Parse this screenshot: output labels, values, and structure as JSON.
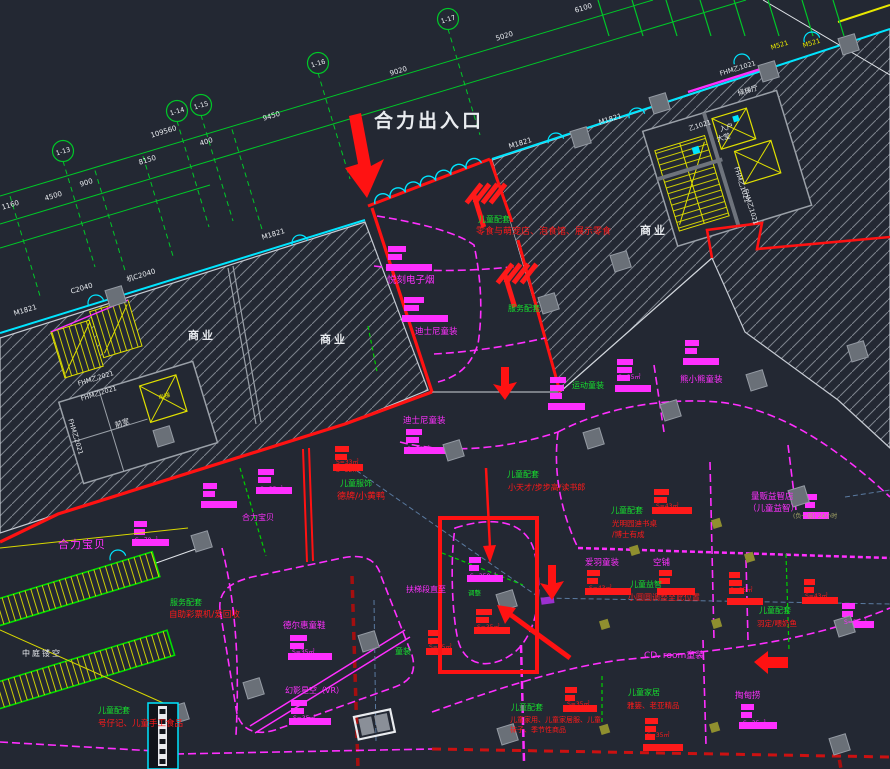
{
  "colors": {
    "background": "#232833",
    "green": "#16e02e",
    "red": "#ff1a1a",
    "magenta": "#ff2fff",
    "cyan": "#00e5ff",
    "yellow": "#e8e800",
    "white": "#e9ecf0",
    "olive": "#a8a868",
    "grid_green": "#00c828",
    "hatch_gray": "#8d939d"
  },
  "entrance": {
    "label": "合力出入口"
  },
  "grid": {
    "bubbles": [
      {
        "t": "1-13",
        "x": 63,
        "y": 151
      },
      {
        "t": "1-14",
        "x": 177,
        "y": 111
      },
      {
        "t": "1-15",
        "x": 201,
        "y": 105
      },
      {
        "t": "1-16",
        "x": 318,
        "y": 63
      },
      {
        "t": "1-17",
        "x": 448,
        "y": 19
      }
    ],
    "dims": [
      {
        "t": "1160",
        "x": 1,
        "y": 205
      },
      {
        "t": "4500",
        "x": 44,
        "y": 196
      },
      {
        "t": "900",
        "x": 79,
        "y": 182
      },
      {
        "t": "8150",
        "x": 138,
        "y": 160
      },
      {
        "t": "109560",
        "x": 150,
        "y": 133
      },
      {
        "t": "400",
        "x": 199,
        "y": 141
      },
      {
        "t": "9450",
        "x": 262,
        "y": 116
      },
      {
        "t": "9020",
        "x": 389,
        "y": 71
      },
      {
        "t": "5020",
        "x": 495,
        "y": 36
      },
      {
        "t": "6100",
        "x": 574,
        "y": 8
      }
    ]
  },
  "labels": {
    "areas": [
      {
        "t": "商业",
        "x": 188,
        "y": 330,
        "c": "w",
        "s": 11,
        "ls": 3,
        "b": 1
      },
      {
        "t": "商业",
        "x": 320,
        "y": 334,
        "c": "w",
        "s": 11,
        "ls": 3,
        "b": 1
      },
      {
        "t": "商业",
        "x": 640,
        "y": 225,
        "c": "w",
        "s": 11,
        "ls": 3,
        "b": 1
      },
      {
        "t": "中庭镂空",
        "x": 22,
        "y": 650,
        "c": "w",
        "s": 8,
        "ls": 2
      },
      {
        "t": "前室",
        "x": 114,
        "y": 422,
        "c": "w",
        "s": 7.5,
        "r": -17
      },
      {
        "t": "入户",
        "x": 719,
        "y": 127,
        "c": "w",
        "s": 7,
        "r": -17
      },
      {
        "t": "大堂",
        "x": 716,
        "y": 137,
        "c": "w",
        "s": 7,
        "r": -17
      },
      {
        "t": "候梯厅",
        "x": 737,
        "y": 91,
        "c": "w",
        "s": 7,
        "r": -17
      }
    ],
    "doors": [
      {
        "t": "M1821",
        "x": 13,
        "y": 311,
        "c": "w",
        "s": 7,
        "r": -17
      },
      {
        "t": "C2040",
        "x": 70,
        "y": 289,
        "c": "w",
        "s": 7,
        "r": -17
      },
      {
        "t": "机C2040",
        "x": 126,
        "y": 277,
        "c": "w",
        "s": 7,
        "r": -17
      },
      {
        "t": "M1821",
        "x": 261,
        "y": 235,
        "c": "w",
        "s": 7,
        "r": -17
      },
      {
        "t": "M1821",
        "x": 508,
        "y": 144,
        "c": "w",
        "s": 7,
        "r": -17
      },
      {
        "t": "M1821",
        "x": 598,
        "y": 120,
        "c": "w",
        "s": 7,
        "r": -17
      },
      {
        "t": "FHM乙2021",
        "x": 77,
        "y": 381,
        "c": "w",
        "s": 6.5,
        "r": -17
      },
      {
        "t": "FHM乙2021",
        "x": 80,
        "y": 396,
        "c": "w",
        "s": 6.5,
        "r": -17
      },
      {
        "t": "FHM乙2021",
        "x": 73,
        "y": 418,
        "c": "w",
        "s": 6.5,
        "r": 73
      },
      {
        "t": "FHM乙1021",
        "x": 719,
        "y": 71,
        "c": "w",
        "s": 6.5,
        "r": -17
      },
      {
        "t": "乙1021",
        "x": 688,
        "y": 126,
        "c": "w",
        "s": 6.5,
        "r": -17
      },
      {
        "t": "FHM乙1021",
        "x": 739,
        "y": 166,
        "c": "w",
        "s": 6.5,
        "r": 73
      },
      {
        "t": "FHM乙1021",
        "x": 748,
        "y": 188,
        "c": "w",
        "s": 6.5,
        "r": 73
      },
      {
        "t": "M521",
        "x": 770,
        "y": 45,
        "c": "y",
        "s": 6.5,
        "r": -17
      },
      {
        "t": "M521",
        "x": 802,
        "y": 43,
        "c": "y",
        "s": 6.5,
        "r": -17
      },
      {
        "t": "电梯",
        "x": 158,
        "y": 396,
        "c": "y",
        "s": 6,
        "r": -17
      }
    ],
    "categories": [
      {
        "t": "儿童配套",
        "x": 478,
        "y": 216,
        "c": "g",
        "s": 8
      },
      {
        "t": "服务配套",
        "x": 508,
        "y": 305,
        "c": "g",
        "s": 8
      },
      {
        "t": "儿童服饰",
        "x": 340,
        "y": 480,
        "c": "g",
        "s": 8
      },
      {
        "t": "儿童配套",
        "x": 507,
        "y": 471,
        "c": "g",
        "s": 8
      },
      {
        "t": "运动童装",
        "x": 572,
        "y": 382,
        "c": "g",
        "s": 8
      },
      {
        "t": "儿童配套",
        "x": 611,
        "y": 507,
        "c": "g",
        "s": 8
      },
      {
        "t": "儿童益智",
        "x": 630,
        "y": 581,
        "c": "g",
        "s": 8
      },
      {
        "t": "儿童配套",
        "x": 759,
        "y": 607,
        "c": "g",
        "s": 8
      },
      {
        "t": "服务配套",
        "x": 170,
        "y": 599,
        "c": "g",
        "s": 8
      },
      {
        "t": "儿童配套",
        "x": 98,
        "y": 707,
        "c": "g",
        "s": 8
      },
      {
        "t": "童装",
        "x": 395,
        "y": 648,
        "c": "g",
        "s": 8
      },
      {
        "t": "儿童配套",
        "x": 511,
        "y": 704,
        "c": "g",
        "s": 8
      },
      {
        "t": "儿童家居",
        "x": 628,
        "y": 689,
        "c": "g",
        "s": 8
      },
      {
        "t": "调整",
        "x": 468,
        "y": 590,
        "c": "g",
        "s": 6.5
      }
    ],
    "shops_red": [
      {
        "t": "零食与萌宠店、泡食馆、展示零食",
        "x": 476,
        "y": 228,
        "c": "r",
        "s": 9
      },
      {
        "t": "德牌/小黄鸭",
        "x": 337,
        "y": 493,
        "c": "r",
        "s": 9
      },
      {
        "t": "小天才/步步高/读书郎",
        "x": 508,
        "y": 484,
        "c": "r",
        "s": 8
      },
      {
        "t": "光明园迪书桌",
        "x": 612,
        "y": 520,
        "c": "r",
        "s": 7.5
      },
      {
        "t": "/博士有成",
        "x": 612,
        "y": 531,
        "c": "r",
        "s": 7.5
      },
      {
        "t": "小圆圆调整至此位置",
        "x": 628,
        "y": 594,
        "c": "r",
        "s": 8
      },
      {
        "t": "羽定/喂奶鱼",
        "x": 757,
        "y": 620,
        "c": "r",
        "s": 7.5
      },
      {
        "t": "自助彩票机/爱回收",
        "x": 169,
        "y": 611,
        "c": "r",
        "s": 8.5
      },
      {
        "t": "号仔记、儿童手工食品",
        "x": 98,
        "y": 720,
        "c": "r",
        "s": 8.5
      },
      {
        "t": "儿童家用、儿童家居服、儿童",
        "x": 510,
        "y": 717,
        "c": "r",
        "s": 7
      },
      {
        "t": "袜子、季节性商品",
        "x": 510,
        "y": 727,
        "c": "r",
        "s": 7
      },
      {
        "t": "雅篓、老亚精品",
        "x": 627,
        "y": 702,
        "c": "r",
        "s": 7.5
      }
    ],
    "shops_magenta": [
      {
        "t": "悦刻电子烟",
        "x": 387,
        "y": 276,
        "c": "m",
        "s": 9.5
      },
      {
        "t": "迪士尼童装",
        "x": 415,
        "y": 328,
        "c": "m",
        "s": 8.5
      },
      {
        "t": "迪士尼童装",
        "x": 403,
        "y": 417,
        "c": "m",
        "s": 8.5
      },
      {
        "t": "合力宝贝",
        "x": 242,
        "y": 514,
        "c": "m",
        "s": 8
      },
      {
        "t": "合力宝贝",
        "x": 58,
        "y": 539,
        "c": "m",
        "s": 11,
        "ls": 1
      },
      {
        "t": "德尔惠童鞋",
        "x": 283,
        "y": 622,
        "c": "m",
        "s": 8.5
      },
      {
        "t": "幻影星空（VR）",
        "x": 285,
        "y": 687,
        "c": "m",
        "s": 8
      },
      {
        "t": "熊小熊童装",
        "x": 680,
        "y": 376,
        "c": "m",
        "s": 8.5
      },
      {
        "t": "量贩益智店",
        "x": 751,
        "y": 493,
        "c": "m",
        "s": 8.5
      },
      {
        "t": "（儿童益智）",
        "x": 748,
        "y": 505,
        "c": "m",
        "s": 8.5
      },
      {
        "t": "爱羽童装",
        "x": 585,
        "y": 559,
        "c": "m",
        "s": 8.5
      },
      {
        "t": "空铺",
        "x": 653,
        "y": 559,
        "c": "m",
        "s": 8.5
      },
      {
        "t": "CD. room童装",
        "x": 644,
        "y": 652,
        "c": "m",
        "s": 9
      },
      {
        "t": "掏甸捞",
        "x": 735,
        "y": 692,
        "c": "m",
        "s": 8.5
      },
      {
        "t": "扶梯段直至",
        "x": 406,
        "y": 586,
        "c": "m",
        "s": 8
      }
    ],
    "tiny_areas": [
      {
        "t": "S=35㎡",
        "x": 389,
        "y": 266,
        "c": "m",
        "s": 6
      },
      {
        "t": "S=35㎡",
        "x": 403,
        "y": 317,
        "c": "m",
        "s": 6
      },
      {
        "t": "S=35㎡",
        "x": 407,
        "y": 447,
        "c": "m",
        "s": 6
      },
      {
        "t": "S=35㎡",
        "x": 260,
        "y": 487,
        "c": "m",
        "s": 6
      },
      {
        "t": "S=78㎡",
        "x": 135,
        "y": 538,
        "c": "m",
        "s": 6
      },
      {
        "t": "S=35㎡",
        "x": 292,
        "y": 650,
        "c": "m",
        "s": 6
      },
      {
        "t": "S=35㎡",
        "x": 293,
        "y": 716,
        "c": "m",
        "s": 6
      },
      {
        "t": "S=35㎡",
        "x": 743,
        "y": 721,
        "c": "m",
        "s": 6
      },
      {
        "t": "S=350㎡",
        "x": 470,
        "y": 574,
        "c": "m",
        "s": 6
      },
      {
        "t": "S=35㎡",
        "x": 844,
        "y": 620,
        "c": "m",
        "s": 6
      },
      {
        "t": "S=35㎡",
        "x": 618,
        "y": 375,
        "c": "m",
        "s": 6
      },
      {
        "t": "S=33㎡",
        "x": 336,
        "y": 460,
        "c": "r",
        "s": 6
      },
      {
        "t": "S=22㎡",
        "x": 336,
        "y": 468,
        "c": "r",
        "s": 6
      },
      {
        "t": "S=35㎡",
        "x": 477,
        "y": 625,
        "c": "r",
        "s": 6
      },
      {
        "t": "S=35㎡",
        "x": 429,
        "y": 645,
        "c": "r",
        "s": 6
      },
      {
        "t": "S=43㎡",
        "x": 589,
        "y": 586,
        "c": "r",
        "s": 6
      },
      {
        "t": "S=43㎡",
        "x": 805,
        "y": 594,
        "c": "r",
        "s": 6
      },
      {
        "t": "S=35㎡",
        "x": 567,
        "y": 702,
        "c": "r",
        "s": 6
      },
      {
        "t": "S=35㎡",
        "x": 647,
        "y": 733,
        "c": "r",
        "s": 6
      },
      {
        "t": "S=43㎡",
        "x": 656,
        "y": 504,
        "c": "r",
        "s": 6
      },
      {
        "t": "S=35㎡",
        "x": 730,
        "y": 588,
        "c": "r",
        "s": 6
      },
      {
        "t": "(负一层) 24小时",
        "x": 793,
        "y": 514,
        "c": "o",
        "s": 6
      }
    ]
  }
}
